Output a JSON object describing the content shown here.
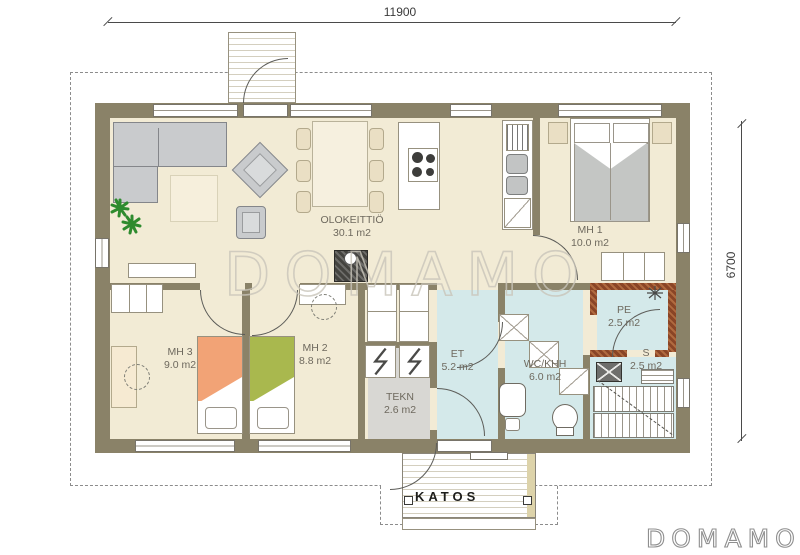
{
  "branding": {
    "watermark": "DOMAMO",
    "logo": "DOMAMO"
  },
  "dimensions": {
    "width_mm": "11900",
    "height_mm": "6700"
  },
  "rooms": [
    {
      "id": "olokeittio",
      "name": "OLOKEITTIÖ",
      "area": "30.1 m2"
    },
    {
      "id": "mh1",
      "name": "MH 1",
      "area": "10.0 m2"
    },
    {
      "id": "mh3",
      "name": "MH 3",
      "area": "9.0 m2"
    },
    {
      "id": "mh2",
      "name": "MH 2",
      "area": "8.8 m2"
    },
    {
      "id": "et",
      "name": "ET",
      "area": "5.2 m2"
    },
    {
      "id": "wc",
      "name": "WC/KHH",
      "area": "6.0 m2"
    },
    {
      "id": "tekn",
      "name": "TEKN",
      "area": "2.6 m2"
    },
    {
      "id": "pe",
      "name": "PE",
      "area": "2.5 m2"
    },
    {
      "id": "s",
      "name": "S",
      "area": "2.5 m2"
    }
  ],
  "outdoor": {
    "katos_label": "KATOS"
  },
  "colors": {
    "wall": "#8a8268",
    "fire_wall": "#8a4526",
    "floor_main": "#f2ebd5",
    "floor_wet": "#d4e9ea",
    "floor_tech": "#d8d7d3",
    "bed_orange": "#f2a376",
    "bed_green": "#a9b84e",
    "sofa_gray": "#c9cbcd",
    "plant_green": "#2e8b2e"
  }
}
